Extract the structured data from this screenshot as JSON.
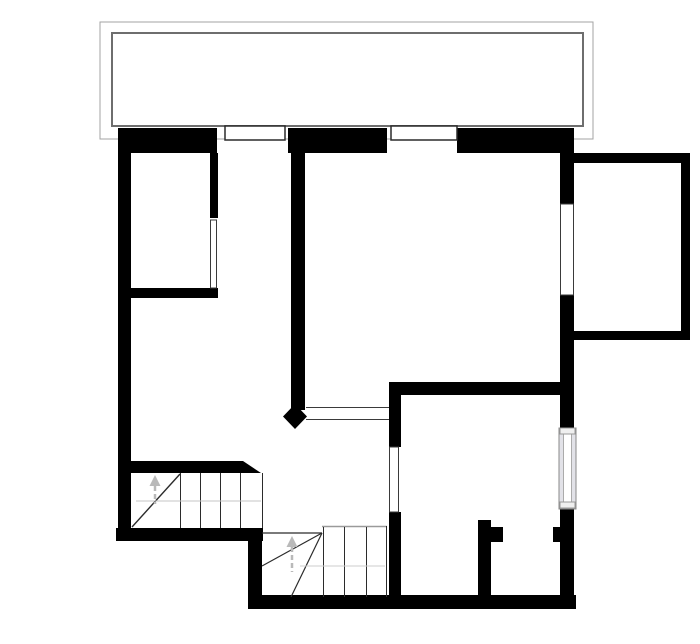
{
  "document": {
    "kind": "floor-plan-drawing",
    "storey": "upper-floor",
    "visible_text": [],
    "background_color": "#ffffff",
    "wall_color": "#000000",
    "thin_line_color": "#3a3a3a",
    "guide_color": "#bdbdbd",
    "canvas": {
      "w": 700,
      "h": 644
    }
  },
  "shapes": [
    {
      "name": "balcony-outer-outline",
      "type": "rect",
      "x": 100,
      "y": 22,
      "w": 493,
      "h": 117,
      "fill": "none",
      "stroke": "#a3a3a3",
      "sw": 1
    },
    {
      "name": "balcony-inner-outline",
      "type": "rect",
      "x": 112,
      "y": 33,
      "w": 471,
      "h": 93,
      "fill": "none",
      "stroke": "#6e6e6e",
      "sw": 2
    },
    {
      "name": "north-wall-west-segment",
      "type": "rect",
      "x": 118,
      "y": 128,
      "w": 99,
      "h": 25,
      "fill": "#000000"
    },
    {
      "name": "north-wall-mid-segment",
      "type": "rect",
      "x": 288,
      "y": 128,
      "w": 99,
      "h": 25,
      "fill": "#000000"
    },
    {
      "name": "north-wall-east-segment",
      "type": "rect",
      "x": 457,
      "y": 128,
      "w": 117,
      "h": 25,
      "fill": "#000000"
    },
    {
      "name": "west-wall",
      "type": "rect",
      "x": 118,
      "y": 128,
      "w": 13,
      "h": 413,
      "fill": "#000000"
    },
    {
      "name": "east-wall-upper",
      "type": "rect",
      "x": 560,
      "y": 128,
      "w": 14,
      "h": 76,
      "fill": "#000000"
    },
    {
      "name": "east-wall-mid",
      "type": "rect",
      "x": 560,
      "y": 295,
      "w": 14,
      "h": 134,
      "fill": "#000000"
    },
    {
      "name": "east-wall-lower",
      "type": "rect",
      "x": 560,
      "y": 509,
      "w": 14,
      "h": 100,
      "fill": "#000000"
    },
    {
      "name": "south-wall",
      "type": "rect",
      "x": 248,
      "y": 595,
      "w": 328,
      "h": 14,
      "fill": "#000000"
    },
    {
      "name": "stair-south-wall",
      "type": "rect",
      "x": 116,
      "y": 528,
      "w": 147,
      "h": 13,
      "fill": "#000000"
    },
    {
      "name": "south-step-wall",
      "type": "rect",
      "x": 248,
      "y": 528,
      "w": 14,
      "h": 81,
      "fill": "#000000"
    },
    {
      "name": "stair-north-wall",
      "type": "rect",
      "x": 118,
      "y": 461,
      "w": 125,
      "h": 12,
      "fill": "#000000"
    },
    {
      "name": "stair-north-wall-chamfer",
      "type": "poly",
      "points": [
        [
          243,
          461
        ],
        [
          261,
          473
        ],
        [
          243,
          473
        ]
      ],
      "fill": "#000000"
    },
    {
      "name": "bedroom-partition-vertical",
      "type": "rect",
      "x": 210,
      "y": 153,
      "w": 8,
      "h": 65,
      "fill": "#000000"
    },
    {
      "name": "bedroom-partition-horizontal",
      "type": "rect",
      "x": 118,
      "y": 288,
      "w": 100,
      "h": 10,
      "fill": "#000000"
    },
    {
      "name": "central-partition-wall",
      "type": "rect",
      "x": 291,
      "y": 140,
      "w": 14,
      "h": 270,
      "fill": "#000000"
    },
    {
      "name": "door-pivot-diamond",
      "type": "poly",
      "points": [
        [
          295,
          404
        ],
        [
          307,
          416.5
        ],
        [
          295,
          429
        ],
        [
          283,
          416.5
        ]
      ],
      "fill": "#000000"
    },
    {
      "name": "backroom-north-wall",
      "type": "rect",
      "x": 389,
      "y": 382,
      "w": 171,
      "h": 13,
      "fill": "#000000"
    },
    {
      "name": "backroom-west-wall-upper",
      "type": "rect",
      "x": 389,
      "y": 382,
      "w": 12,
      "h": 65,
      "fill": "#000000"
    },
    {
      "name": "backroom-west-wall-lower",
      "type": "rect",
      "x": 389,
      "y": 512,
      "w": 12,
      "h": 90,
      "fill": "#000000"
    },
    {
      "name": "closet-partition-wall",
      "type": "rect",
      "x": 478,
      "y": 520,
      "w": 13,
      "h": 83,
      "fill": "#000000"
    },
    {
      "name": "closet-door-jamb-west",
      "type": "rect",
      "x": 491,
      "y": 527,
      "w": 12,
      "h": 15,
      "fill": "#000000"
    },
    {
      "name": "closet-door-jamb-east",
      "type": "rect",
      "x": 553,
      "y": 527,
      "w": 9,
      "h": 15,
      "fill": "#000000"
    },
    {
      "name": "bay-north-wall",
      "type": "rect",
      "x": 574,
      "y": 153,
      "w": 116,
      "h": 10,
      "fill": "#000000"
    },
    {
      "name": "bay-east-wall",
      "type": "rect",
      "x": 681,
      "y": 153,
      "w": 9,
      "h": 187,
      "fill": "#000000"
    },
    {
      "name": "bay-south-wall",
      "type": "rect",
      "x": 574,
      "y": 331,
      "w": 116,
      "h": 9,
      "fill": "#000000"
    },
    {
      "name": "north-window-west-frame",
      "type": "rect",
      "x": 225,
      "y": 126,
      "w": 60,
      "h": 14,
      "fill": "#ffffff",
      "stroke": "#2b2b2b",
      "sw": 1.5
    },
    {
      "name": "north-window-mid-frame",
      "type": "rect",
      "x": 391,
      "y": 126,
      "w": 66,
      "h": 14,
      "fill": "#ffffff",
      "stroke": "#2b2b2b",
      "sw": 1.5
    },
    {
      "name": "east-window-upper",
      "type": "rect",
      "x": 560.5,
      "y": 204,
      "w": 13,
      "h": 91,
      "fill": "#ffffff",
      "stroke": "#3a3a3a",
      "sw": 1
    },
    {
      "name": "bedroom-door-opening",
      "type": "rect",
      "x": 210.5,
      "y": 220,
      "w": 6,
      "h": 68,
      "fill": "#ffffff",
      "stroke": "#3a3a3a",
      "sw": 1
    },
    {
      "name": "backroom-door-opening",
      "type": "rect",
      "x": 389.5,
      "y": 447,
      "w": 9,
      "h": 65,
      "fill": "#ffffff",
      "stroke": "#3a3a3a",
      "sw": 1
    },
    {
      "name": "central-doorway-line-top",
      "type": "line",
      "x1": 306,
      "y1": 407.5,
      "x2": 389,
      "y2": 407.5,
      "stroke": "#3a3a3a",
      "sw": 1
    },
    {
      "name": "central-doorway-line-bottom",
      "type": "line",
      "x1": 306,
      "y1": 419.5,
      "x2": 389,
      "y2": 419.5,
      "stroke": "#3a3a3a",
      "sw": 1
    },
    {
      "name": "east-window-lower-frame",
      "type": "rect",
      "x": 559,
      "y": 428,
      "w": 17,
      "h": 81,
      "fill": "#e2e2e8",
      "stroke": "#8a8a8a",
      "sw": 1
    },
    {
      "name": "east-window-lower-glass",
      "type": "rect",
      "x": 563.5,
      "y": 434,
      "w": 8,
      "h": 69,
      "fill": "#ffffff",
      "stroke": "#ababab",
      "sw": 1
    },
    {
      "name": "east-window-lower-cap-top",
      "type": "rect",
      "x": 560,
      "y": 428,
      "w": 15,
      "h": 6,
      "fill": "#efefef",
      "stroke": "#999999",
      "sw": 1
    },
    {
      "name": "east-window-lower-cap-bottom",
      "type": "rect",
      "x": 560,
      "y": 502,
      "w": 15,
      "h": 6,
      "fill": "#efefef",
      "stroke": "#999999",
      "sw": 1
    },
    {
      "name": "stair1-right-edge-line",
      "type": "line",
      "x1": 262.5,
      "y1": 473,
      "x2": 262.5,
      "y2": 528,
      "stroke": "#2b2b2b",
      "sw": 1
    },
    {
      "name": "stair1-tread-line-1",
      "type": "line",
      "x1": 180.5,
      "y1": 473,
      "x2": 180.5,
      "y2": 528,
      "stroke": "#2b2b2b",
      "sw": 1
    },
    {
      "name": "stair1-tread-line-2",
      "type": "line",
      "x1": 200.5,
      "y1": 473,
      "x2": 200.5,
      "y2": 528,
      "stroke": "#2b2b2b",
      "sw": 1
    },
    {
      "name": "stair1-tread-line-3",
      "type": "line",
      "x1": 220.5,
      "y1": 473,
      "x2": 220.5,
      "y2": 528,
      "stroke": "#2b2b2b",
      "sw": 1
    },
    {
      "name": "stair1-tread-line-4",
      "type": "line",
      "x1": 240.5,
      "y1": 473,
      "x2": 240.5,
      "y2": 528,
      "stroke": "#2b2b2b",
      "sw": 1
    },
    {
      "name": "stair1-winder-diagonal",
      "type": "line",
      "x1": 132,
      "y1": 527,
      "x2": 180,
      "y2": 474,
      "stroke": "#2b2b2b",
      "sw": 1.4
    },
    {
      "name": "stair1-walking-line",
      "type": "line",
      "x1": 136,
      "y1": 501,
      "x2": 261,
      "y2": 501,
      "stroke": "#c4c4c4",
      "sw": 1
    },
    {
      "name": "stair1-up-arrow-head",
      "type": "poly",
      "points": [
        [
          155,
          475
        ],
        [
          149.5,
          486
        ],
        [
          160.5,
          486
        ]
      ],
      "fill": "#b9b9b9"
    },
    {
      "name": "stair1-up-arrow-stem",
      "type": "line",
      "x1": 155,
      "y1": 486,
      "x2": 155,
      "y2": 504,
      "stroke": "#b9b9b9",
      "sw": 2.5,
      "dash": "5,3"
    },
    {
      "name": "stair2-top-edge-line",
      "type": "line",
      "x1": 262,
      "y1": 533,
      "x2": 322,
      "y2": 533,
      "stroke": "#2b2b2b",
      "sw": 1.2
    },
    {
      "name": "stair2-landing-edge-line",
      "type": "line",
      "x1": 322,
      "y1": 526.5,
      "x2": 387,
      "y2": 526.5,
      "stroke": "#9a9a9a",
      "sw": 1.5
    },
    {
      "name": "stair2-right-edge-line",
      "type": "line",
      "x1": 386.5,
      "y1": 526,
      "x2": 386.5,
      "y2": 597,
      "stroke": "#2b2b2b",
      "sw": 1
    },
    {
      "name": "stair2-tread-line-1",
      "type": "line",
      "x1": 323.5,
      "y1": 527,
      "x2": 323.5,
      "y2": 597,
      "stroke": "#2b2b2b",
      "sw": 1
    },
    {
      "name": "stair2-tread-line-2",
      "type": "line",
      "x1": 344.5,
      "y1": 527,
      "x2": 344.5,
      "y2": 597,
      "stroke": "#2b2b2b",
      "sw": 1
    },
    {
      "name": "stair2-tread-line-3",
      "type": "line",
      "x1": 366.5,
      "y1": 527,
      "x2": 366.5,
      "y2": 597,
      "stroke": "#2b2b2b",
      "sw": 1
    },
    {
      "name": "stair2-winder-diagonal-1",
      "type": "line",
      "x1": 322,
      "y1": 533,
      "x2": 262,
      "y2": 566,
      "stroke": "#2b2b2b",
      "sw": 1.2
    },
    {
      "name": "stair2-winder-diagonal-2",
      "type": "line",
      "x1": 322,
      "y1": 533,
      "x2": 291,
      "y2": 597,
      "stroke": "#2b2b2b",
      "sw": 1.2
    },
    {
      "name": "stair2-walking-line",
      "type": "line",
      "x1": 300,
      "y1": 566,
      "x2": 385,
      "y2": 566,
      "stroke": "#cccccc",
      "sw": 1
    },
    {
      "name": "stair2-up-arrow-head",
      "type": "poly",
      "points": [
        [
          292,
          536
        ],
        [
          286.5,
          547
        ],
        [
          297.5,
          547
        ]
      ],
      "fill": "#b9b9b9"
    },
    {
      "name": "stair2-up-arrow-stem",
      "type": "line",
      "x1": 292,
      "y1": 547,
      "x2": 292,
      "y2": 572,
      "stroke": "#b9b9b9",
      "sw": 2.5,
      "dash": "5,3"
    }
  ]
}
